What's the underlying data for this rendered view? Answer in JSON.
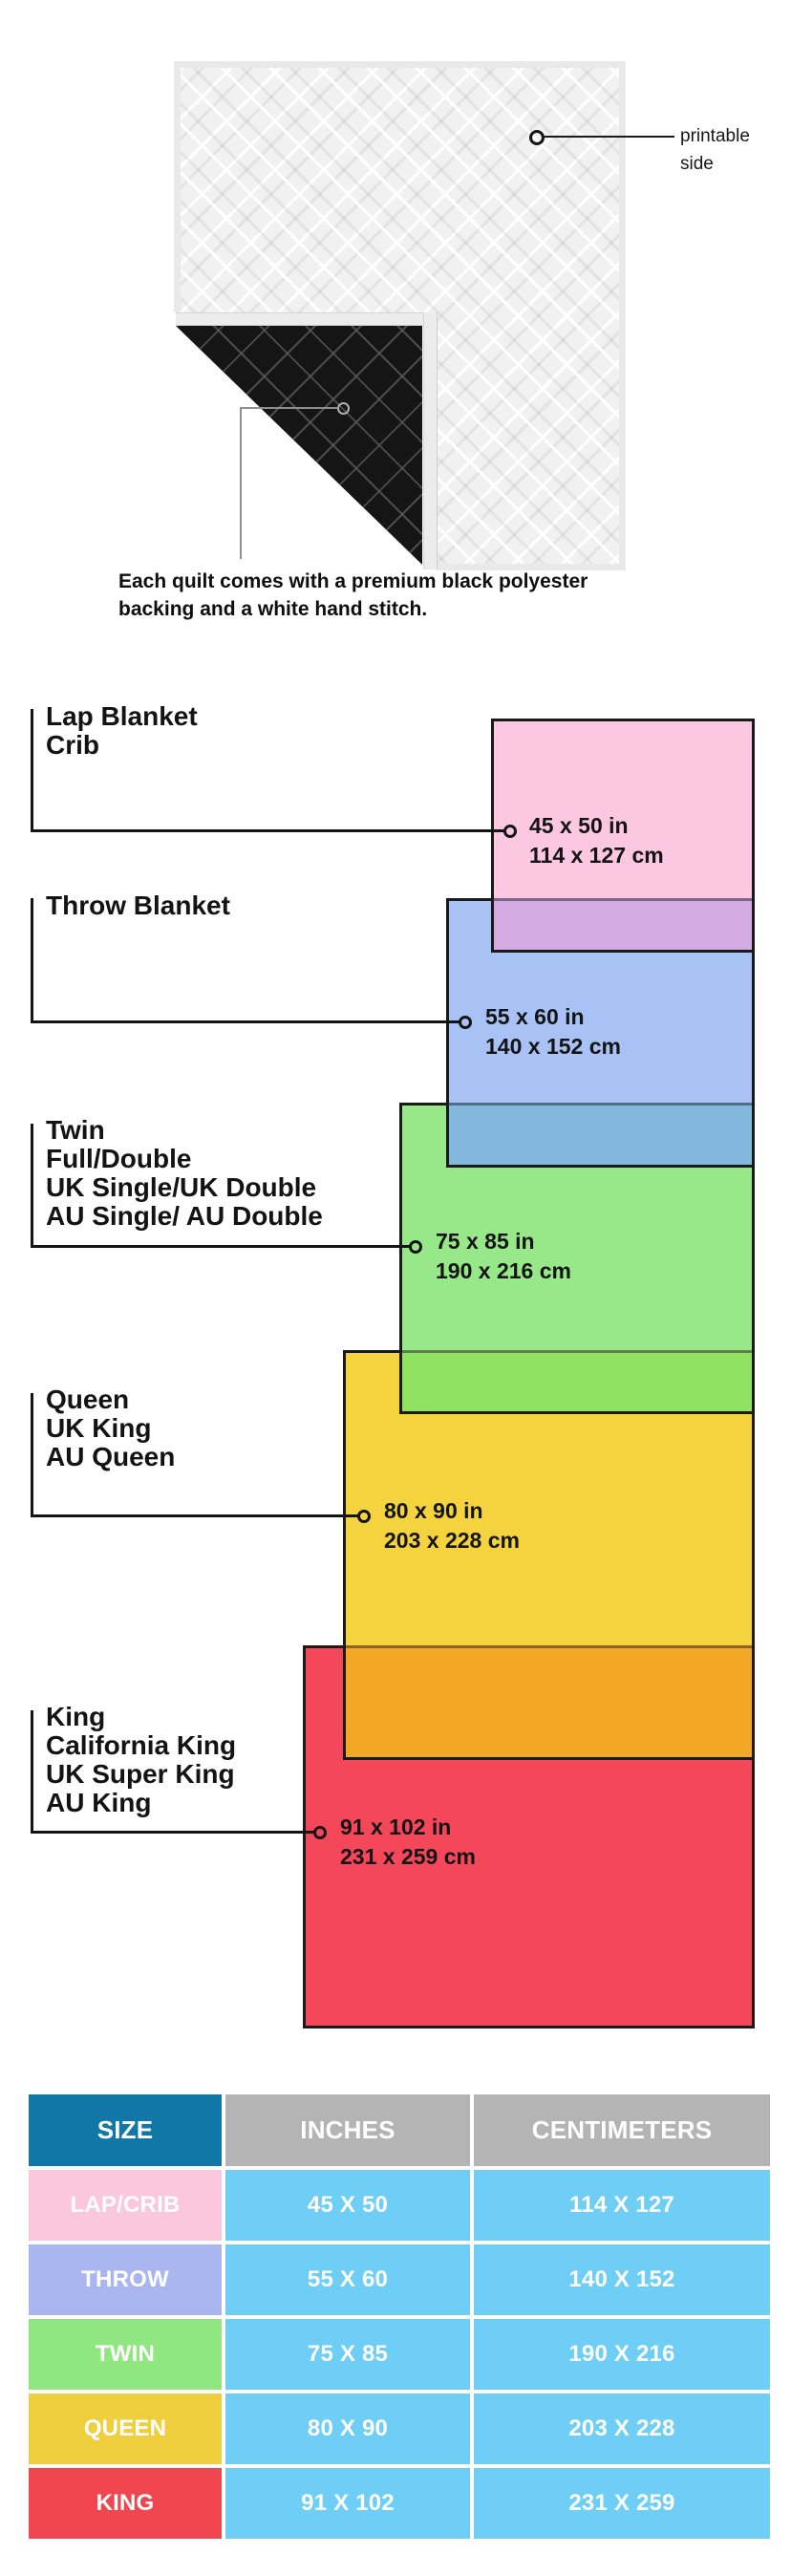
{
  "quilt": {
    "printable_label_line1": "printable",
    "printable_label_line2": "side",
    "caption": "Each quilt comes with a premium black polyester backing and a white hand stitch."
  },
  "diagram": {
    "sizes": [
      {
        "names": [
          "Lap Blanket",
          "Crib"
        ],
        "inches": "45 x 50 in",
        "cm": "114 x 127 cm",
        "fill": "#fbc7e1",
        "band": "#d3abe2"
      },
      {
        "names": [
          "Throw Blanket"
        ],
        "inches": "55 x 60 in",
        "cm": "140 x 152 cm",
        "fill": "#a8c2f6",
        "band": "#81b8dc"
      },
      {
        "names": [
          "Twin",
          "Full/Double",
          "UK Single/UK Double",
          "AU Single/ AU Double"
        ],
        "inches": "75 x 85 in",
        "cm": "190 x 216 cm",
        "fill": "#97e888",
        "band": "#8ee25f"
      },
      {
        "names": [
          "Queen",
          "UK King",
          "AU Queen"
        ],
        "inches": "80 x 90 in",
        "cm": "203 x 228 cm",
        "fill": "#f4d33f",
        "band": "#f2a824"
      },
      {
        "names": [
          "King",
          "California King",
          "UK Super King",
          "AU King"
        ],
        "inches": "91 x 102 in",
        "cm": "231 x 259 cm",
        "fill": "#f4485a",
        "band": null
      }
    ]
  },
  "table": {
    "headers": [
      "SIZE",
      "INCHES",
      "CENTIMETERS"
    ],
    "header_colors": {
      "size": "#1177a7",
      "metric": "#b4b4b4"
    },
    "value_cell_color": "#6fcef5",
    "rows": [
      {
        "size": "LAP/CRIB",
        "inches": "45 X 50",
        "cm": "114 X 127",
        "color": "#fac7dc"
      },
      {
        "size": "THROW",
        "inches": "55 X 60",
        "cm": "140 X 152",
        "color": "#a9b6f0"
      },
      {
        "size": "TWIN",
        "inches": "75 X 85",
        "cm": "190 X 216",
        "color": "#90e781"
      },
      {
        "size": "QUEEN",
        "inches": "80 X 90",
        "cm": "203 X 228",
        "color": "#f0cf3e"
      },
      {
        "size": "KING",
        "inches": "91 X 102",
        "cm": "231 X 259",
        "color": "#f0464f"
      }
    ]
  }
}
